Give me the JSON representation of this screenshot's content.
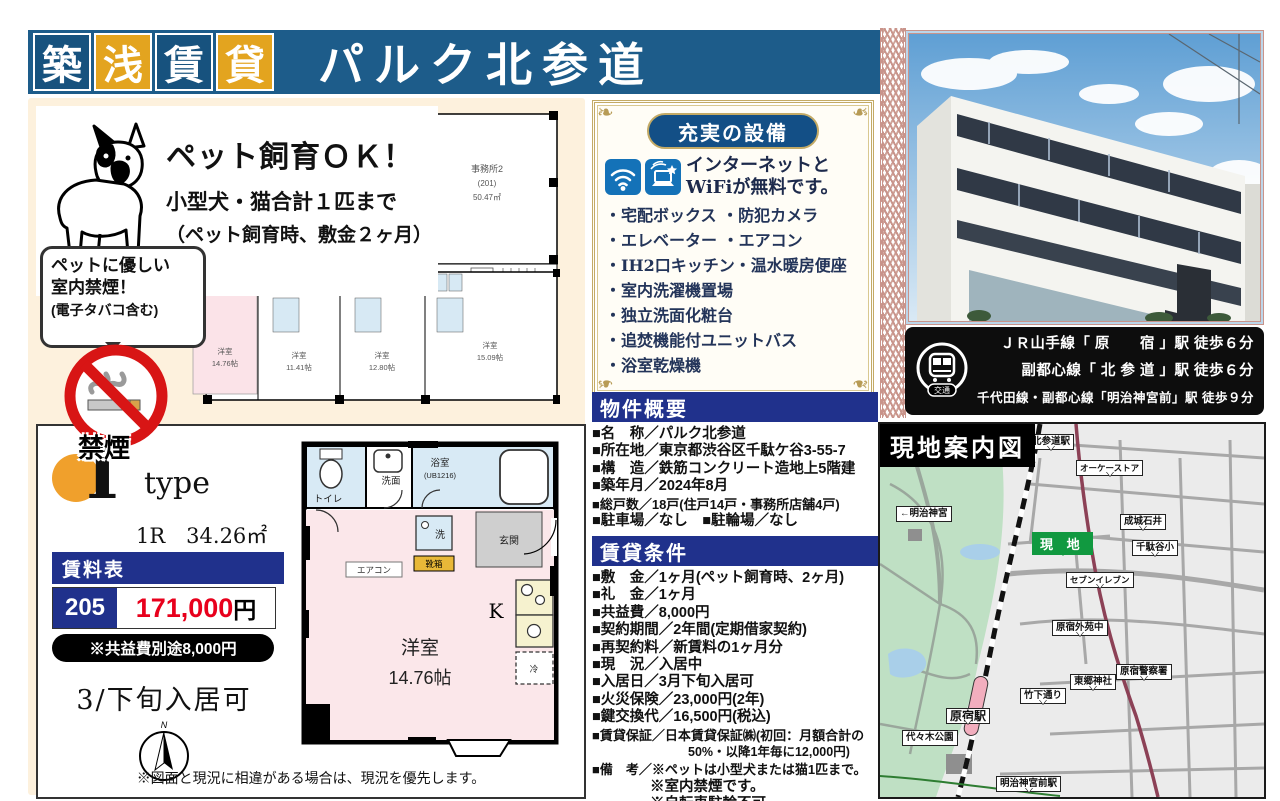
{
  "banner": {
    "chars": [
      "築",
      "浅",
      "賃",
      "貸"
    ],
    "title": "パルク北参道"
  },
  "pet": {
    "headline": "ペット飼育ＯＫ！",
    "line1": "小型犬・猫合計１匹まで",
    "line2": "（ペット飼育時、敷金２ヶ月）",
    "bubble1": "ペットに優しい",
    "bubble2": "室内禁煙！",
    "bubble3": "(電子タバコ含む)",
    "no_smoking": "禁煙"
  },
  "building_plan": {
    "office1": "事務所2",
    "office2": "(201)",
    "office3": "50.47㎡",
    "unit1a": "洋室",
    "unit1b": "14.76帖",
    "unit2a": "洋室",
    "unit2b": "11.41帖",
    "unit3a": "洋室",
    "unit3b": "12.80帖",
    "unit4a": "洋室",
    "unit4b": "15.09帖",
    "ev": "EV"
  },
  "equipment": {
    "header": "充実の設備",
    "free1": "インターネットと",
    "free2": "WiFiが無料です。",
    "items": [
      "・宅配ボックス ・防犯カメラ",
      "・エレベーター ・エアコン",
      "・IH2口キッチン・温水暖房便座",
      "・室内洗濯機置場",
      "・独立洗面化粧台",
      "・追焚機能付ユニットバス",
      "・浴室乾燥機"
    ]
  },
  "overview": {
    "header": "物件概要",
    "rows": [
      "■名　称／パルク北参道",
      "■所在地／東京都渋谷区千駄ケ谷3-55-7",
      "■構　造／鉄筋コンクリート造地上5階建",
      "■築年月／2024年8月",
      "■総戸数／18戸(住戸14戸・事務所店舗4戸)",
      "■駐車場／なし　■駐輪場／なし"
    ]
  },
  "conditions": {
    "header": "賃貸条件",
    "rows": [
      "■敷　金／1ヶ月(ペット飼育時、2ヶ月)",
      "■礼　金／1ヶ月",
      "■共益費／8,000円",
      "■契約期間／2年間(定期借家契約)",
      "■再契約料／新賃料の1ヶ月分",
      "■現　況／入居中",
      "■入居日／3月下旬入居可",
      "■火災保険／23,000円(2年)",
      "■鍵交換代／16,500円(税込)",
      "■賃貸保証／日本賃貸保証㈱(初回：月額合計の",
      "50%・以降1年毎に12,000円)",
      "■備　考／※ペットは小型犬または猫1匹まで。",
      "※室内禁煙です。",
      "※自転車駐輪不可。"
    ]
  },
  "access": {
    "badge": "交通",
    "line1": "ＪＲ山手線「 原　　宿 」駅 徒歩６分",
    "line2": "副都心線「 北 参 道 」駅 徒歩６分",
    "line3": "千代田線・副都心線「明治神宮前」駅 徒歩９分"
  },
  "unit": {
    "type_letter": "I",
    "type_word": "type",
    "spec": "1R　34.26㎡",
    "rent_header": "賃料表",
    "room_no": "205",
    "rent": "171,000",
    "yen": "円",
    "fee_note": "※共益費別途8,000円",
    "move_in": "3/下旬入居可",
    "disclaimer": "※図面と現況に相違がある場合は、現況を優先します。"
  },
  "floor_plan": {
    "toilet": "トイレ",
    "wash": "洗面",
    "bath": "浴室",
    "bath_sub": "(UB1216)",
    "entrance": "玄関",
    "washer": "洗",
    "shoebox": "靴箱",
    "aircon": "エアコン",
    "kitchen": "K",
    "fridge": "冷",
    "room": "洋室",
    "size": "14.76帖",
    "compass_n": "N"
  },
  "map": {
    "title": "現地案内図",
    "site": "現 地",
    "labels": [
      {
        "text": "北参道駅"
      },
      {
        "text": "オーケーストア"
      },
      {
        "text": "←明治神宮"
      },
      {
        "text": "成城石井"
      },
      {
        "text": "千駄谷小"
      },
      {
        "text": "セブンイレブン"
      },
      {
        "text": "原宿外苑中"
      },
      {
        "text": "東郷神社"
      },
      {
        "text": "原宿警察署"
      },
      {
        "text": "竹下通り"
      },
      {
        "text": "原宿駅"
      },
      {
        "text": "代々木公園"
      },
      {
        "text": "明治神宮前駅"
      }
    ]
  },
  "colors": {
    "navy": "#1d5c8a",
    "gold": "#e3a41f",
    "header_navy": "#20318c",
    "rent_red": "#e8001c"
  }
}
